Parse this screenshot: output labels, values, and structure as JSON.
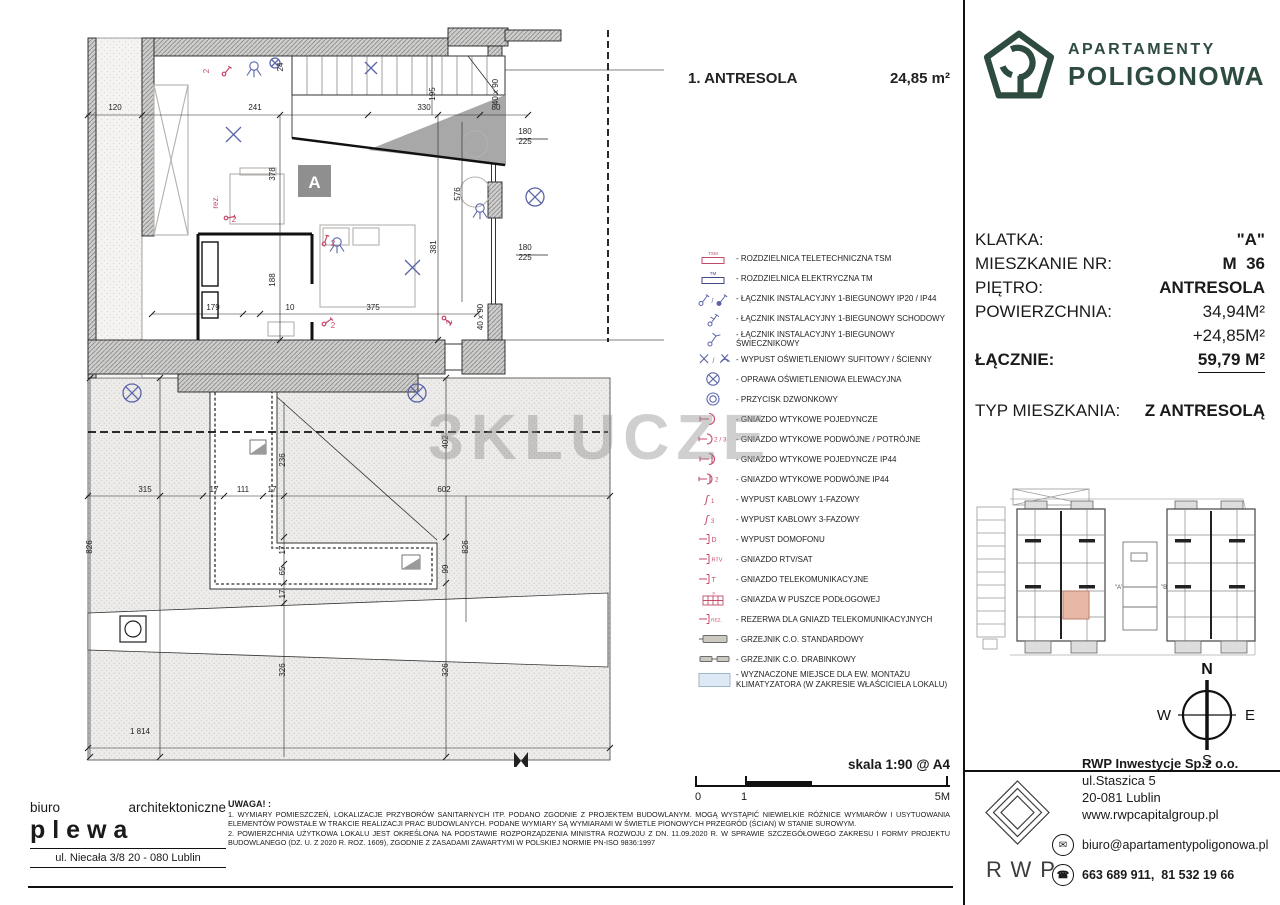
{
  "page": {
    "watermark": "3KLUCZE",
    "scale_label": "skala 1:90 @ A4",
    "scale_ticks": [
      "0",
      "1",
      "5M"
    ]
  },
  "plan": {
    "title": "1. ANTRESOLA",
    "area": "24,85 m²",
    "room_label": "A",
    "dimensions": [
      {
        "t": "120",
        "x": 87,
        "y": 88
      },
      {
        "t": "241",
        "x": 227,
        "y": 88
      },
      {
        "t": "330",
        "x": 396,
        "y": 88
      },
      {
        "t": "80",
        "x": 468,
        "y": 88
      },
      {
        "t": "24",
        "x": 255,
        "y": 45,
        "r": 1,
        "s": 7
      },
      {
        "t": "195",
        "x": 407,
        "y": 72,
        "r": 1
      },
      {
        "t": "378",
        "x": 247,
        "y": 152,
        "r": 1
      },
      {
        "t": "188",
        "x": 247,
        "y": 258,
        "r": 1
      },
      {
        "t": "179",
        "x": 185,
        "y": 288
      },
      {
        "t": "10",
        "x": 262,
        "y": 288,
        "s": 7
      },
      {
        "t": "375",
        "x": 345,
        "y": 288
      },
      {
        "t": "381",
        "x": 408,
        "y": 225,
        "r": 1
      },
      {
        "t": "576",
        "x": 432,
        "y": 172,
        "r": 1
      },
      {
        "t": "40 x 90",
        "x": 470,
        "y": 70,
        "r": 1,
        "s": 6
      },
      {
        "t": "40 x 90",
        "x": 455,
        "y": 295,
        "r": 1,
        "s": 6
      },
      {
        "t": "180",
        "x": 497,
        "y": 112,
        "s": 6
      },
      {
        "t": "225",
        "x": 497,
        "y": 122,
        "s": 6
      },
      {
        "t": "180",
        "x": 497,
        "y": 228,
        "s": 6
      },
      {
        "t": "225",
        "x": 497,
        "y": 238,
        "s": 6
      },
      {
        "t": "315",
        "x": 117,
        "y": 470
      },
      {
        "t": "17",
        "x": 186,
        "y": 470,
        "s": 7
      },
      {
        "t": "111",
        "x": 215,
        "y": 470
      },
      {
        "t": "17",
        "x": 244,
        "y": 470,
        "s": 7
      },
      {
        "t": "602",
        "x": 416,
        "y": 470
      },
      {
        "t": "236",
        "x": 257,
        "y": 438,
        "r": 1
      },
      {
        "t": "402",
        "x": 420,
        "y": 420,
        "r": 1
      },
      {
        "t": "826",
        "x": 440,
        "y": 525,
        "r": 1
      },
      {
        "t": "99",
        "x": 420,
        "y": 547,
        "r": 1
      },
      {
        "t": "17",
        "x": 257,
        "y": 528,
        "r": 1,
        "s": 7
      },
      {
        "t": "65",
        "x": 257,
        "y": 549,
        "r": 1
      },
      {
        "t": "17",
        "x": 257,
        "y": 572,
        "r": 1,
        "s": 7
      },
      {
        "t": "326",
        "x": 257,
        "y": 648,
        "r": 1
      },
      {
        "t": "326",
        "x": 420,
        "y": 648,
        "r": 1
      },
      {
        "t": "826",
        "x": 64,
        "y": 525,
        "r": 1
      },
      {
        "t": "1 814",
        "x": 112,
        "y": 712
      },
      {
        "t": "2",
        "x": 181,
        "y": 49,
        "r": 1,
        "c": "red",
        "s": 7
      },
      {
        "t": "rez.",
        "x": 190,
        "y": 180,
        "r": 1,
        "c": "red",
        "s": 7
      },
      {
        "t": "2",
        "x": 206,
        "y": 200,
        "c": "red",
        "s": 7
      },
      {
        "t": "2",
        "x": 305,
        "y": 224,
        "c": "red",
        "s": 7
      },
      {
        "t": "2",
        "x": 305,
        "y": 306,
        "c": "red",
        "s": 7
      },
      {
        "t": "2",
        "x": 424,
        "y": 300,
        "r": 1,
        "c": "red",
        "s": 7
      }
    ]
  },
  "legend": {
    "items": [
      {
        "symbol": "tsm",
        "label": "ROZDZIELNICA TELETECHNICZNA TSM"
      },
      {
        "symbol": "tm",
        "label": "ROZDZIELNICA ELEKTRYCZNA TM"
      },
      {
        "symbol": "sw1",
        "label": "ŁĄCZNIK INSTALACYJNY 1-BIEGUNOWY IP20 / IP44"
      },
      {
        "symbol": "swstair",
        "label": "ŁĄCZNIK INSTALACYJNY 1-BIEGUNOWY SCHODOWY"
      },
      {
        "symbol": "swchand",
        "label": "ŁĄCZNIK INSTALACYJNY 1-BIEGUNOWY ŚWIECZNIKOWY"
      },
      {
        "symbol": "xceil",
        "label": "WYPUST OŚWIETLENIOWY SUFITOWY / ŚCIENNY"
      },
      {
        "symbol": "elev",
        "label": "OPRAWA OŚWIETLENIOWA ELEWACYJNA"
      },
      {
        "symbol": "bell",
        "label": "PRZYCISK DZWONKOWY"
      },
      {
        "symbol": "s1",
        "label": "GNIAZDO WTYKOWE POJEDYNCZE"
      },
      {
        "symbol": "s23",
        "label": "GNIAZDO WTYKOWE PODWÓJNE / POTRÓJNE"
      },
      {
        "symbol": "s144",
        "label": "GNIAZDO WTYKOWE POJEDYNCZE IP44"
      },
      {
        "symbol": "s244",
        "label": "GNIAZDO WTYKOWE PODWÓJNE IP44"
      },
      {
        "symbol": "c1f",
        "label": "WYPUST KABLOWY 1-FAZOWY"
      },
      {
        "symbol": "c3f",
        "label": "WYPUST KABLOWY 3-FAZOWY"
      },
      {
        "symbol": "dom",
        "label": "WYPUST DOMOFONU"
      },
      {
        "symbol": "rtv",
        "label": "GNIAZDO RTV/SAT"
      },
      {
        "symbol": "tel",
        "label": "GNIAZDO TELEKOMUNIKACYJNE"
      },
      {
        "symbol": "fbox",
        "label": "GNIAZDA W PUSZCE PODŁOGOWEJ"
      },
      {
        "symbol": "rez",
        "label": "REZERWA DLA GNIAZD TELEKOMUNIKACYJNYCH"
      },
      {
        "symbol": "radstd",
        "label": "GRZEJNIK C.O. STANDARDOWY"
      },
      {
        "symbol": "radlad",
        "label": "GRZEJNIK C.O. DRABINKOWY"
      },
      {
        "symbol": "ac",
        "label": "WYZNACZONE MIEJSCE DLA EW. MONTAŻU KLIMATYZATORA (W ZAKRESIE WŁAŚCICIELA LOKALU)"
      }
    ]
  },
  "brand": {
    "line1": "APARTAMENTY",
    "line2": "POLIGONOWA"
  },
  "info": {
    "rows": [
      {
        "label": "KLATKA:",
        "value": "\"A\"",
        "bold": true
      },
      {
        "label": "MIESZKANIE NR:",
        "value": "M  36",
        "bold": true
      },
      {
        "label": "PIĘTRO:",
        "value": "ANTRESOLA",
        "bold": true
      },
      {
        "label": "POWIERZCHNIA:",
        "value": "34,94M²"
      },
      {
        "label": "",
        "value": "+24,85M²"
      },
      {
        "label": "ŁĄCZNIE:",
        "value": "59,79 M²",
        "bold": true,
        "underline": true,
        "labelBold": true
      },
      {
        "label": "TYP MIESZKANIA:",
        "value": "Z ANTRESOLĄ",
        "bold": true,
        "gap": true
      }
    ]
  },
  "siteplan": {
    "building_a_label": "\"A\"",
    "building_b_label": "\"B\""
  },
  "compass": {
    "n": "N",
    "e": "E",
    "s": "S",
    "w": "W"
  },
  "developer": {
    "logo_text": "RWP",
    "company": "RWP Inwestycje Sp.z o.o.",
    "address1": "ul.Staszica 5",
    "address2": "20-081 Lublin",
    "website": "www.rwpcapitalgroup.pl",
    "email": "biuro@apartamentypoligonowa.pl",
    "phones": "663 689 911,  81 532 19 66"
  },
  "architect": {
    "word1": "biuro",
    "word2": "architektoniczne",
    "name": "p l e w a",
    "address": "ul. Niecała 3/8  20 - 080 Lublin"
  },
  "notes": {
    "heading": "UWAGA! :",
    "items": [
      "1. WYMIARY POMIESZCZEŃ, LOKALIZACJE PRZYBORÓW SANITARNYCH ITP. PODANO ZGODNIE Z PROJEKTEM BUDOWLANYM. MOGĄ WYSTĄPIĆ NIEWIELKIE RÓŻNICE WYMIARÓW I USYTUOWANIA ELEMENTÓW POWSTAŁE W TRAKCIE REALIZACJI PRAC BUDOWLANYCH. PODANE WYMIARY SĄ WYMIARAMI W ŚWIETLE PIONOWYCH PRZEGRÓD (ŚCIAN) W STANIE SUROWYM.",
      "2. POWIERZCHNIA UŻYTKOWA LOKALU JEST OKREŚLONA NA PODSTAWIE ROZPORZĄDZENIA MINISTRA ROZWOJU Z DN. 11.09.2020 R. W SPRAWIE SZCZEGÓŁOWEGO ZAKRESU I FORMY PROJEKTU BUDOWLANEGO (DZ. U. Z 2020 R. ROZ. 1609), ZGODNIE Z ZASADAMI ZAWARTYMI W POLSKIEJ NORMIE PN-ISO 9836:1997"
    ]
  },
  "colors": {
    "brand_green": "#2e4b3f",
    "symbol_red": "#c44a68",
    "symbol_blue": "#5a64a8",
    "highlight": "#e9b7a6"
  }
}
